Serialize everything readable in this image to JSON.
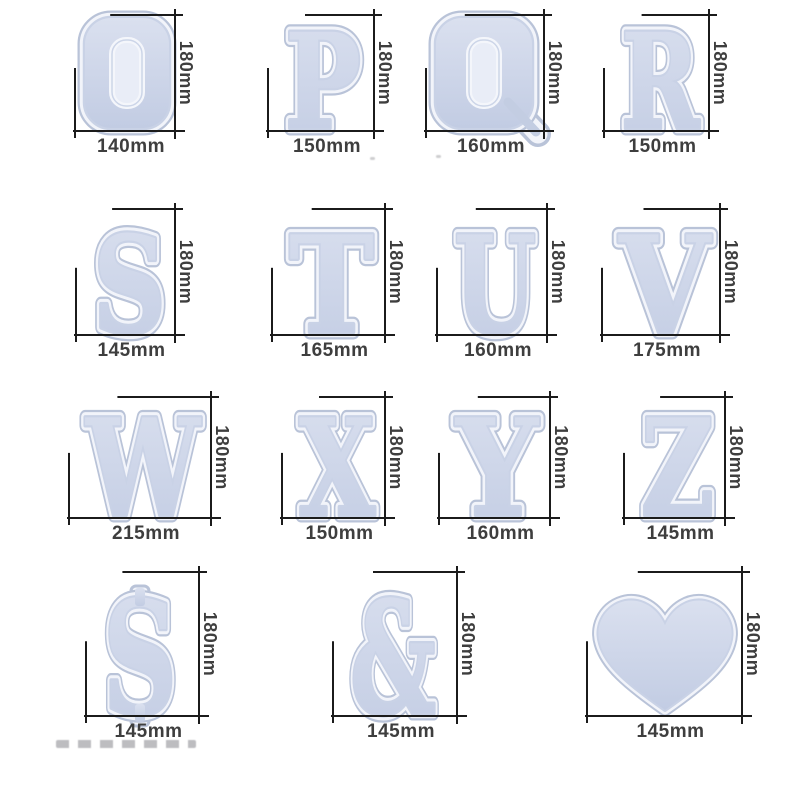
{
  "colors": {
    "dimension_line": "#1b1b1b",
    "dimension_label": "#3e3e3e",
    "mold_rim": "#f2f4fa",
    "mold_outline": "#b9c3d8",
    "mold_inner_line": "#c9d2e6",
    "mold_cavity_top": "#dae0ef",
    "mold_cavity_bottom": "#c2cce3",
    "mold_plug": "#e9edf7",
    "background": "#ffffff"
  },
  "items": [
    {
      "id": "o",
      "glyph": "O",
      "width_label": "140mm",
      "height_label": "180mm"
    },
    {
      "id": "p",
      "glyph": "P",
      "width_label": "150mm",
      "height_label": "180mm"
    },
    {
      "id": "q",
      "glyph": "Q",
      "width_label": "160mm",
      "height_label": "180mm"
    },
    {
      "id": "r",
      "glyph": "R",
      "width_label": "150mm",
      "height_label": "180mm"
    },
    {
      "id": "s",
      "glyph": "S",
      "width_label": "145mm",
      "height_label": "180mm"
    },
    {
      "id": "t",
      "glyph": "T",
      "width_label": "165mm",
      "height_label": "180mm"
    },
    {
      "id": "u",
      "glyph": "U",
      "width_label": "160mm",
      "height_label": "180mm"
    },
    {
      "id": "v",
      "glyph": "V",
      "width_label": "175mm",
      "height_label": "180mm"
    },
    {
      "id": "w",
      "glyph": "W",
      "width_label": "215mm",
      "height_label": "180mm"
    },
    {
      "id": "x",
      "glyph": "X",
      "width_label": "150mm",
      "height_label": "180mm"
    },
    {
      "id": "y",
      "glyph": "Y",
      "width_label": "160mm",
      "height_label": "180mm"
    },
    {
      "id": "z",
      "glyph": "Z",
      "width_label": "145mm",
      "height_label": "180mm"
    },
    {
      "id": "dollar",
      "glyph": "$",
      "width_label": "145mm",
      "height_label": "180mm"
    },
    {
      "id": "ampersand",
      "glyph": "&",
      "width_label": "145mm",
      "height_label": "180mm"
    },
    {
      "id": "heart",
      "glyph": "♥",
      "width_label": "145mm",
      "height_label": "180mm"
    }
  ]
}
